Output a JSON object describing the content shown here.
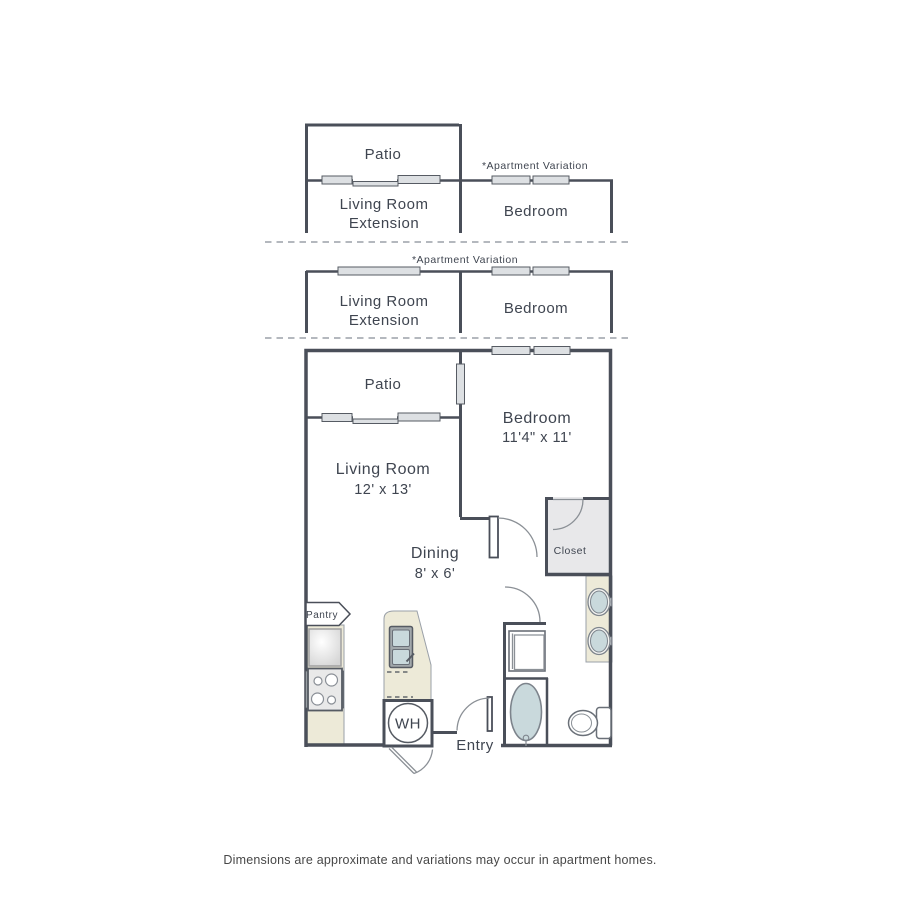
{
  "variation_sections": {
    "section1": {
      "variation_note": "*Apartment Variation",
      "patio": "Patio",
      "living_room_line1": "Living Room",
      "living_room_line2": "Extension",
      "bedroom": "Bedroom"
    },
    "section2": {
      "variation_note": "*Apartment Variation",
      "living_room_line1": "Living Room",
      "living_room_line2": "Extension",
      "bedroom": "Bedroom"
    }
  },
  "floor_plan": {
    "patio": "Patio",
    "living_room": {
      "name": "Living Room",
      "dimensions": "12' x 13'"
    },
    "bedroom": {
      "name": "Bedroom",
      "dimensions": "11'4\" x 11'"
    },
    "dining": {
      "name": "Dining",
      "dimensions": "8' x 6'"
    },
    "closet": "Closet",
    "pantry": "Pantry",
    "water_heater": "WH",
    "entry": "Entry"
  },
  "footer": {
    "disclaimer": "Dimensions are approximate and variations may occur in apartment homes."
  },
  "colors": {
    "wall": "#4a4f59",
    "window_fill": "#dde0e3",
    "counter_beige": "#edead8",
    "fixture_blue": "#c9d9dc",
    "closet_fill": "#e8e8ea",
    "label_text": "#3f4550",
    "door_line": "#8b9096",
    "dashed_divider": "#9ba1a8"
  }
}
